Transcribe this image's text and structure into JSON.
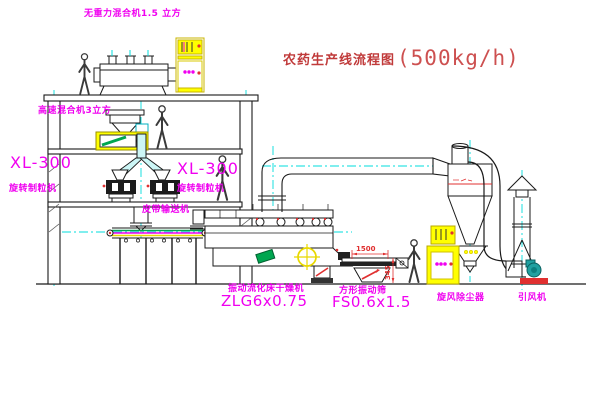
{
  "title": {
    "name": "农药生产线流程图",
    "capacity": "(500kg/h)"
  },
  "labels": {
    "gravity_mixer": "无重力混合机1.5 立方",
    "speed_mixer": "高速混合机3立方",
    "granulator_left_model": "XL-300",
    "granulator_left_name": "旋转制粒机",
    "granulator_right_model": "XL-300",
    "granulator_right_name": "旋转制粒机",
    "belt_conveyor": "皮带输送机",
    "dryer_name": "振动流化床干燥机",
    "dryer_model": "ZLG6x0.75",
    "screen_name": "方形振动筛",
    "screen_model": "FS0.6x1.5",
    "cyclone": "旋风除尘器",
    "fan": "引风机"
  },
  "dimensions": {
    "screen_length": "1500",
    "screen_height": "345"
  },
  "colors": {
    "label_magenta": "#f000f0",
    "title_red": "#c03a3a",
    "detail_red": "#e03030",
    "centerline_cyan": "#00dcdc",
    "cabinet_yellow": "#ffff00",
    "equipment_green": "#00a650",
    "fan_teal": "#20a0a0"
  }
}
